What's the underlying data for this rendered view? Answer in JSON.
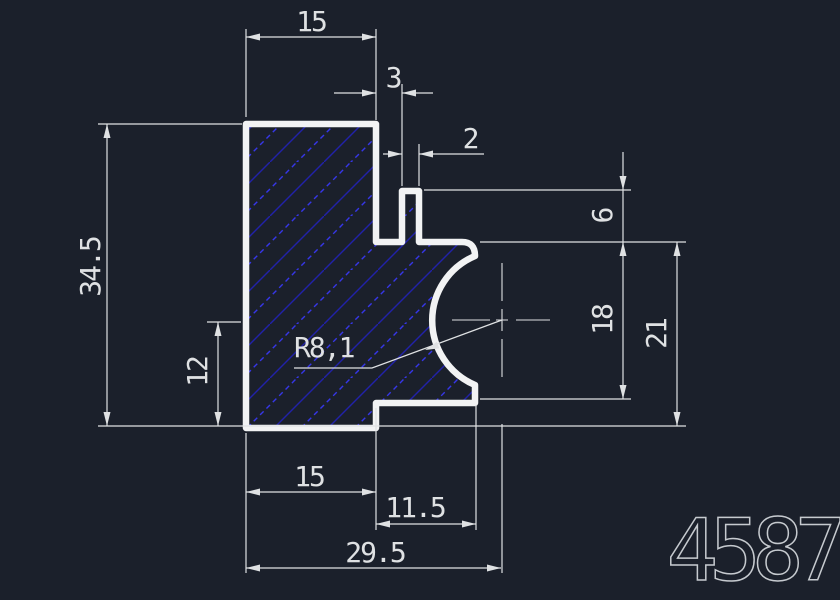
{
  "canvas": {
    "background_color": "#1b202b",
    "line_color": "#dfe1e3",
    "outline_color": "#f2f3f4",
    "hatch_color": "#2121aa",
    "hatch_accent_color": "#3636ea",
    "part_number_color": "#c6cacf"
  },
  "drawing": {
    "part_number": "4587",
    "dimensions": {
      "top_width": "15",
      "notch_gap": "3",
      "tab_width": "2",
      "total_height": "34.5",
      "lower_left_height": "12",
      "tab_height": "6",
      "right_mid_height": "18",
      "right_height": "21",
      "radius": "R8,1",
      "bottom_width": "15",
      "bottom_step_width": "11.5",
      "bottom_overall": "29.5"
    }
  }
}
